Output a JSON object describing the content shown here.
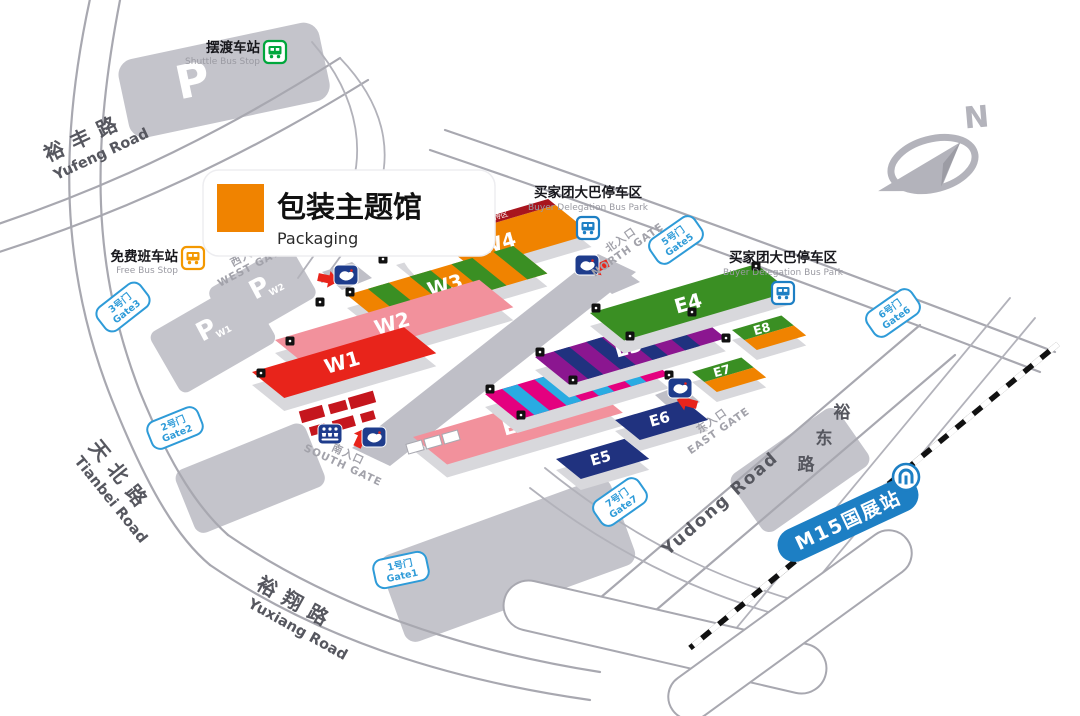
{
  "legend": {
    "title_zh": "包装主题馆",
    "title_en": "Packaging",
    "swatch_color": "#F08300"
  },
  "compass": {
    "north_label": "N"
  },
  "halls": {
    "w1": {
      "label": "W1",
      "color": "#E8241B"
    },
    "w2": {
      "label": "W2",
      "color": "#F2919C"
    },
    "w3": {
      "label": "W3",
      "stripe_colors": [
        "#F08300",
        "#3A8F23"
      ]
    },
    "w4": {
      "label": "W4",
      "color": "#F08300",
      "banner": {
        "text": "买家团接待区",
        "color": "#A8151E"
      }
    },
    "e1": {
      "label": "E1",
      "color": "#F2919C"
    },
    "e2": {
      "label": "E2",
      "stripe_colors": [
        "#E4007F",
        "#29ABE2"
      ]
    },
    "e3": {
      "label": "E3",
      "stripe_colors": [
        "#8B1690",
        "#20327F"
      ]
    },
    "e4": {
      "label": "E4",
      "color": "#3A8F23"
    },
    "e5": {
      "label": "E5",
      "color": "#20327F"
    },
    "e6": {
      "label": "E6",
      "color": "#20327F"
    },
    "e7": {
      "label": "E7",
      "colors": [
        "#3A8F23",
        "#F08300"
      ]
    },
    "e8": {
      "label": "E8",
      "colors": [
        "#3A8F23",
        "#F08300"
      ]
    }
  },
  "gates": {
    "accent_color": "#2E9BD8",
    "gate1": {
      "zh": "1号门",
      "en": "Gate1"
    },
    "gate2": {
      "zh": "2号门",
      "en": "Gate2"
    },
    "gate3": {
      "zh": "3号门",
      "en": "Gate3"
    },
    "gate5": {
      "zh": "5号门",
      "en": "Gate5"
    },
    "gate6": {
      "zh": "6号门",
      "en": "Gate6"
    },
    "gate7": {
      "zh": "7号门",
      "en": "Gate7"
    }
  },
  "entrances": {
    "west": {
      "zh": "西入口",
      "en": "WEST GATE"
    },
    "north": {
      "zh": "北入口",
      "en": "NORTH GATE"
    },
    "east": {
      "zh": "东入口",
      "en": "EAST GATE"
    },
    "south": {
      "zh": "南入口",
      "en": "SOUTH GATE"
    }
  },
  "roads": {
    "yufeng": {
      "zh": "裕丰路",
      "en": "Yufeng Road"
    },
    "tianbei": {
      "zh": "天北路",
      "en": "Tianbei Road"
    },
    "yuxiang": {
      "zh": "裕翔路",
      "en": "Yuxiang Road"
    },
    "yudong": {
      "en": "Yudong Road",
      "zh_chars": [
        "裕",
        "东",
        "路"
      ]
    }
  },
  "transit": {
    "shuttle_bus": {
      "zh": "摆渡车站",
      "en": "Shuttle Bus Stop",
      "color": "#00A73C"
    },
    "free_bus": {
      "zh": "免费班车站",
      "en": "Free Bus Stop",
      "color": "#F39800"
    },
    "buyer_bus_park": {
      "zh": "买家团大巴停车区",
      "en": "Buyer Delegation Bus Park",
      "color": "#1D7FC4"
    },
    "metro": {
      "station": "M15国展站",
      "color": "#1D7FC4"
    }
  },
  "parking": {
    "label": "P",
    "lot_w1": "W1",
    "lot_w2": "W2"
  }
}
